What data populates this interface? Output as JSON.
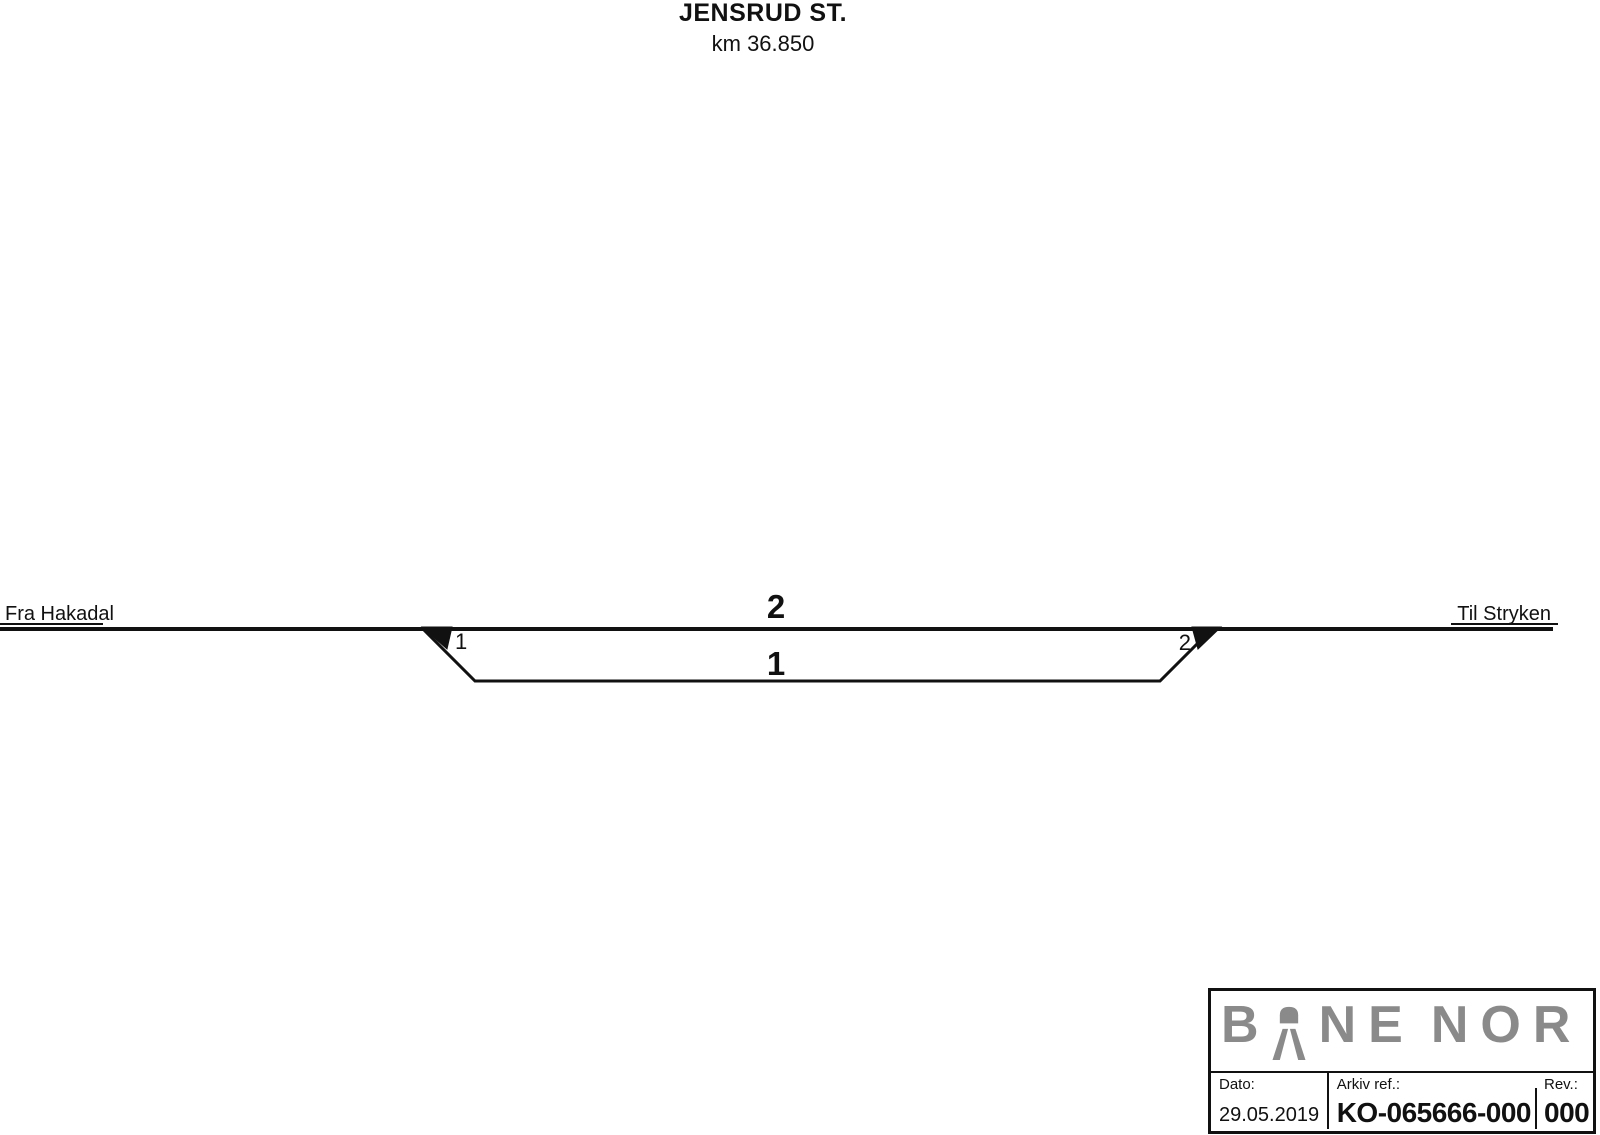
{
  "header": {
    "title": "JENSRUD ST.",
    "subtitle": "km 36.850"
  },
  "diagram": {
    "from_label": "Fra Hakadal",
    "to_label": "Til Stryken",
    "main_track_number": "2",
    "loop_track_number": "1",
    "left_switch_number": "1",
    "right_switch_number": "2"
  },
  "title_block": {
    "logo": {
      "letters": [
        "B",
        "N",
        "E",
        "N",
        "O",
        "R"
      ],
      "symbol_icon": "bane-nor-tunnel-arch-icon",
      "color": "#8a8a8a"
    },
    "date": {
      "label": "Dato:",
      "value": "29.05.2019"
    },
    "archive": {
      "label": "Arkiv ref.:",
      "value": "KO-065666-000"
    },
    "revision": {
      "label": "Rev.:",
      "value": "000"
    }
  },
  "colors": {
    "ink": "#111111",
    "logo_gray": "#8a8a8a"
  }
}
